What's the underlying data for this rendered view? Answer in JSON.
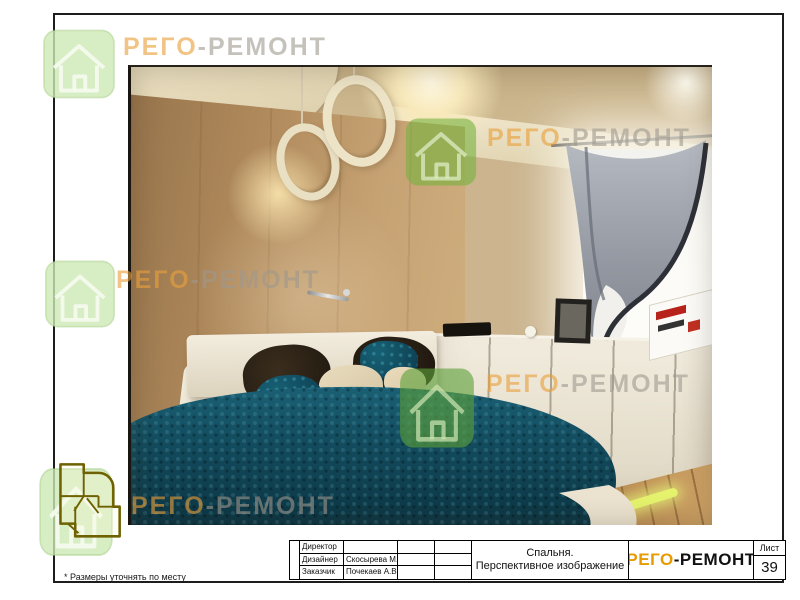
{
  "document": {
    "type": "interior design presentation sheet",
    "footnote": "* Размеры уточнять по месту"
  },
  "brand": {
    "name_part1": "РЕГО",
    "name_part2": "-РЕМОНТ",
    "logo_orange": "#E89B00",
    "watermark_orange": "#E9A03C",
    "watermark_gray": "#9E988E",
    "watermark_green": "#79B448"
  },
  "title_block": {
    "people": [
      {
        "label": "Директор",
        "value": ""
      },
      {
        "label": "Дизайнер",
        "value": "Скосырева М.Г."
      },
      {
        "label": "Заказчик",
        "value": "Почекаев А.В."
      }
    ],
    "drawing_title_line1": "Спальня.",
    "drawing_title_line2": "Перспективное изображение",
    "sheet_label": "Лист",
    "sheet_number": "39"
  },
  "scene": {
    "subject": "Спальня — перспективное изображение",
    "bedspread_teal": "#124C5E",
    "wood_wall_tan": "#B08A5C",
    "cabinet_cream": "#E6DFCD"
  }
}
